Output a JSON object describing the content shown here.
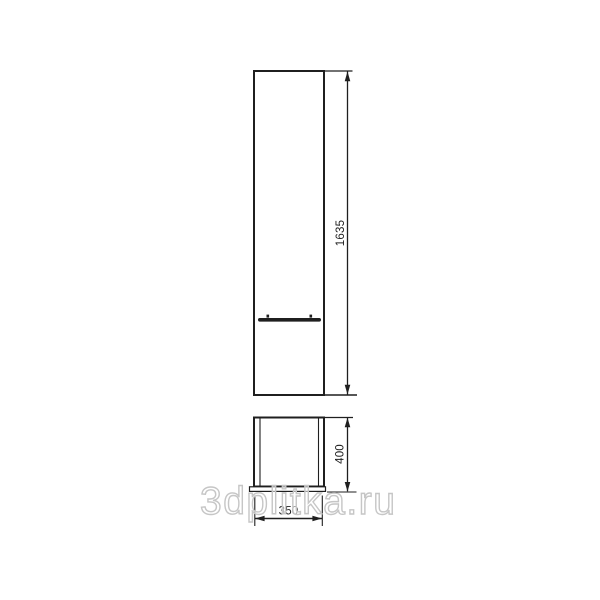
{
  "page": {
    "background": "#ffffff",
    "description_visible_content": "technical dimension drawing of a tall cabinet (front view) and its base footprint view"
  },
  "diagram": {
    "front_view": {
      "height_label": "1635"
    },
    "base_view": {
      "height_label": "400",
      "width_label": "350"
    }
  },
  "watermark": {
    "text": "3dplitka.ru"
  },
  "colors": {
    "line": "#1f1f1f",
    "watermark_outline": "#c6c6c6",
    "background": "#ffffff"
  }
}
